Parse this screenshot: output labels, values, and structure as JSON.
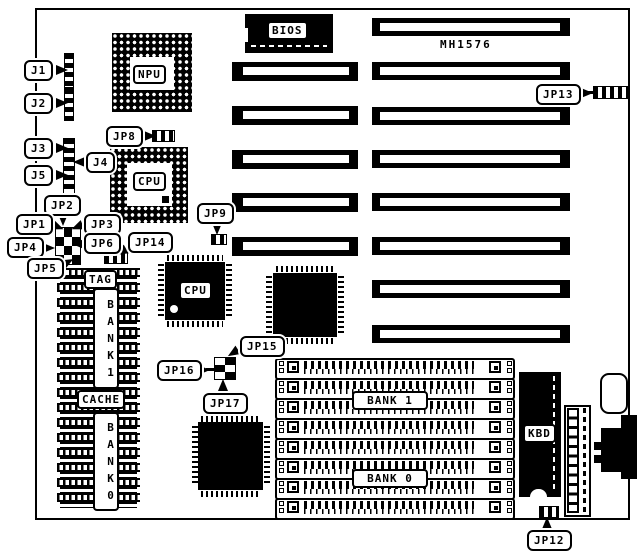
{
  "diagram": {
    "model": "MH1576",
    "ink_color": "#000000",
    "paper_color": "#ffffff"
  },
  "chips": {
    "npu": "NPU",
    "cpu_socket": "CPU",
    "cpu_qfp": "CPU",
    "bios": "BIOS",
    "kbd": "KBD"
  },
  "cache": {
    "tag": "TAG",
    "cache": "CACHE",
    "bank1": "BANK1",
    "bank0": "BANK0",
    "row_count": 16
  },
  "memory": {
    "bank1": "BANK 1",
    "bank0": "BANK 0",
    "simm_count": 8
  },
  "slots": {
    "left_count": 5,
    "right_count": 8
  },
  "callouts": [
    {
      "id": "J1",
      "label": "J1"
    },
    {
      "id": "J2",
      "label": "J2"
    },
    {
      "id": "J3",
      "label": "J3"
    },
    {
      "id": "J4",
      "label": "J4"
    },
    {
      "id": "J5",
      "label": "J5"
    },
    {
      "id": "JP8",
      "label": "JP8"
    },
    {
      "id": "JP2",
      "label": "JP2"
    },
    {
      "id": "JP1",
      "label": "JP1"
    },
    {
      "id": "JP3",
      "label": "JP3"
    },
    {
      "id": "JP6",
      "label": "JP6"
    },
    {
      "id": "JP4",
      "label": "JP4"
    },
    {
      "id": "JP5",
      "label": "JP5"
    },
    {
      "id": "JP14",
      "label": "JP14"
    },
    {
      "id": "JP9",
      "label": "JP9"
    },
    {
      "id": "JP13",
      "label": "JP13"
    },
    {
      "id": "JP15",
      "label": "JP15"
    },
    {
      "id": "JP16",
      "label": "JP16"
    },
    {
      "id": "JP17",
      "label": "JP17"
    },
    {
      "id": "JP12",
      "label": "JP12"
    }
  ]
}
